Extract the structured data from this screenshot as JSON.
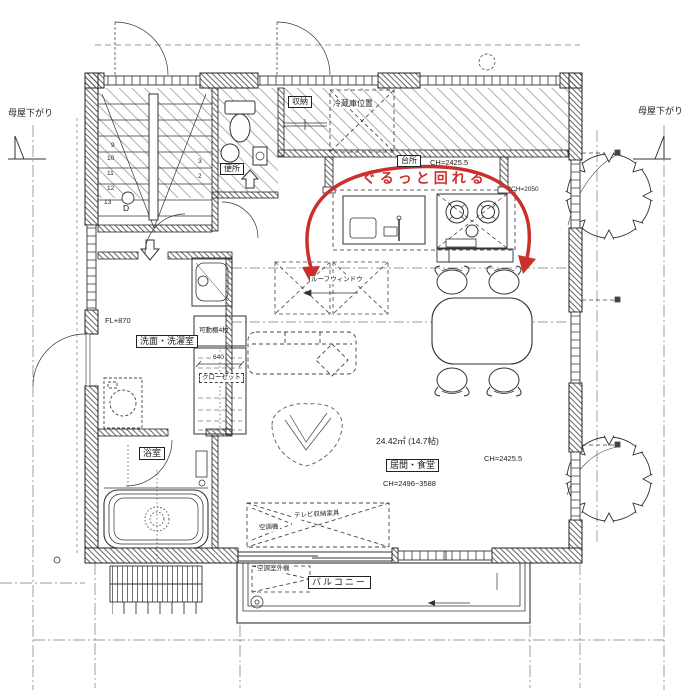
{
  "colors": {
    "line": "#333333",
    "accent_red": "#c9302c"
  },
  "annotations": {
    "route_note": "ぐるっと回れる"
  },
  "rooms": {
    "kitchen": "台所",
    "toilet": "便所",
    "washroom": "洗面・洗濯室",
    "bath": "浴室",
    "living": "居間・食堂"
  },
  "dims": {
    "area": "24.42㎡ (14.7帖)",
    "living_ch_range": "CH=2496~3588",
    "living_ch": "CH=2425.5",
    "kitchen_ch": "CH=2425.5",
    "ch2050": "CH=2050",
    "fl": "FL+870",
    "closet_width": "640"
  },
  "furniture": {
    "storage": "収納",
    "fridge": "冷蔵庫位置",
    "roof_window": "ルーフウィンドウ",
    "shelves": "可動棚4枚",
    "closet": "クローゼット",
    "tv": "テレビ収納家具",
    "ac_indoor": "空調機",
    "ac_outdoor": "空調室外機"
  },
  "exterior": {
    "moya_left": "母屋下がり",
    "moya_right": "母屋下がり",
    "balcony": "バルコニー"
  },
  "stairs": {
    "left": [
      "9",
      "10",
      "11",
      "12",
      "13"
    ],
    "right": [
      "3",
      "2"
    ],
    "point": "D"
  }
}
